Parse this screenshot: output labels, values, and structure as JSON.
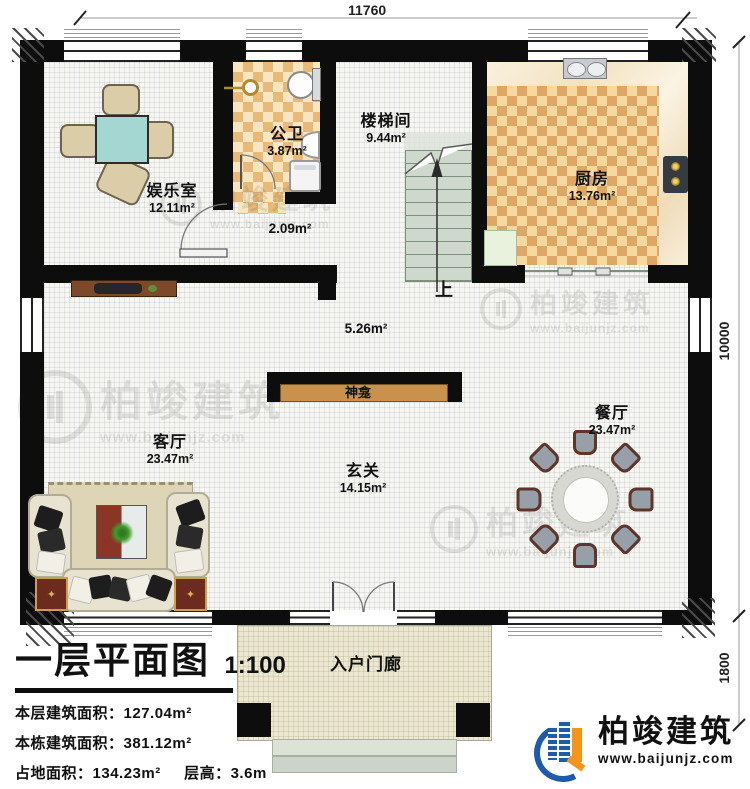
{
  "dimensions": {
    "top_width": "11760",
    "right_main": "10000",
    "right_porch": "1800"
  },
  "rooms": {
    "entertainment": {
      "name": "娱乐室",
      "area": "12.11m²"
    },
    "bathroom": {
      "name": "公卫",
      "area": "3.87m²"
    },
    "stairwell": {
      "name": "楼梯间",
      "area": "9.44m²"
    },
    "kitchen": {
      "name": "厨房",
      "area": "13.76m²"
    },
    "corridor": {
      "area": "2.09m²"
    },
    "hall_upper": {
      "area": "5.26m²"
    },
    "shrine": {
      "name": "神龛"
    },
    "living": {
      "name": "客厅",
      "area": "23.47m²"
    },
    "hall": {
      "name": "玄关",
      "area": "14.15m²"
    },
    "dining": {
      "name": "餐厅",
      "area": "23.47m²"
    },
    "porch": {
      "name": "入户门廊"
    }
  },
  "stairs": {
    "up_label": "上"
  },
  "title_block": {
    "title": "一层平面图",
    "scale": "1:100",
    "floor_area_label": "本层建筑面积：",
    "floor_area": "127.04m²",
    "building_area_label": "本栋建筑面积：",
    "building_area": "381.12m²",
    "footprint_label": "占地面积：",
    "footprint": "134.23m²",
    "height_label": "层高：",
    "height": "3.6m"
  },
  "brand": {
    "name": "柏竣建筑",
    "url": "www.baijunjz.com"
  },
  "colors": {
    "wall": "#0d0d0d",
    "checker_tan": "#e7ba7a",
    "brand_blue": "#1e5cab",
    "brand_orange": "#f7941d",
    "stair_green": "#ced8cc",
    "shrine_shelf": "#c8914c"
  }
}
